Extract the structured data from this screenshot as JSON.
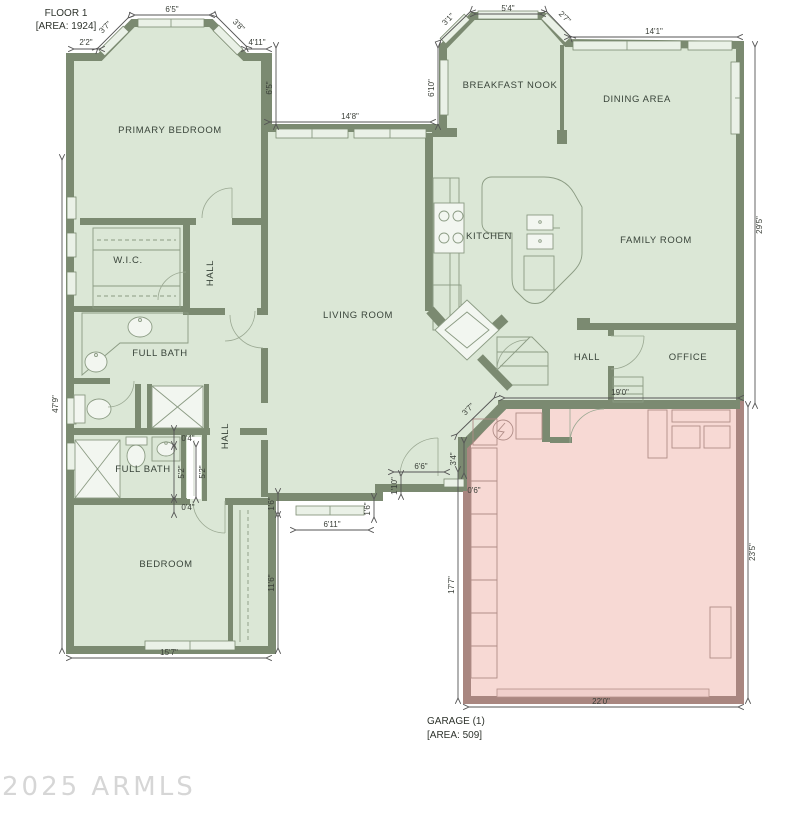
{
  "title": {
    "line1": "FLOOR 1",
    "line2": "[AREA: 1924]"
  },
  "garage_label": {
    "line1": "GARAGE (1)",
    "line2": "[AREA: 509]"
  },
  "watermark": "2025 ARMLS",
  "rooms": {
    "primary_bedroom": "PRIMARY BEDROOM",
    "wic": "W.I.C.",
    "hall_primary": "HALL",
    "full_bath_1": "FULL BATH",
    "full_bath_2": "FULL BATH",
    "hall_bedroom": "HALL",
    "bedroom": "BEDROOM",
    "living_room": "LIVING ROOM",
    "kitchen": "KITCHEN",
    "breakfast_nook": "BREAKFAST NOOK",
    "dining_area": "DINING AREA",
    "family_room": "FAMILY ROOM",
    "hall_rear": "HALL",
    "office": "OFFICE"
  },
  "dims": {
    "bay_left_seg": "2'2\"",
    "bay_left_diag": "3'7\"",
    "bay_top": "6'5\"",
    "bay_right_diag": "3'8\"",
    "bay_right_seg": "4'11\"",
    "left_total": "47'9\"",
    "courtyard_left": "6'5\"",
    "living_window": "14'8\"",
    "courtyard_right": "6'10\"",
    "nook_left_diag": "3'1\"",
    "nook_top": "5'4\"",
    "nook_right_diag": "2'7\"",
    "dining_top": "14'1\"",
    "right_upper": "29'5\"",
    "hall_office_width": "19'0\"",
    "garage_right": "23'5\"",
    "garage_bottom": "22'0\"",
    "garage_left": "17'7\"",
    "entry_wall": "0'6\"",
    "entry_side": "3'4\"",
    "garage_diag": "3'7\"",
    "entry_width": "6'6\"",
    "entry_jog": "1'10\"",
    "porch_jog": "1'6\"",
    "bedroom_window": "6'11\"",
    "closet_jog": "1'6\"",
    "bedroom_right": "11'6\"",
    "bedroom_bottom": "15'7\"",
    "bath_top_gap": "0'4\"",
    "bath_door_a": "5'2\"",
    "bath_door_b": "5'2\"",
    "bath_bottom_gap": "0'4\""
  },
  "colors": {
    "room_fill": "#dbe7d6",
    "wall": "#7b8a71",
    "garage_fill": "#f7d9d4",
    "garage_wall": "#a98680",
    "window_fill": "#eaf1e7",
    "dim_text": "#3a3f38",
    "label_text": "#39443a",
    "watermark": "#d6d6d6"
  }
}
